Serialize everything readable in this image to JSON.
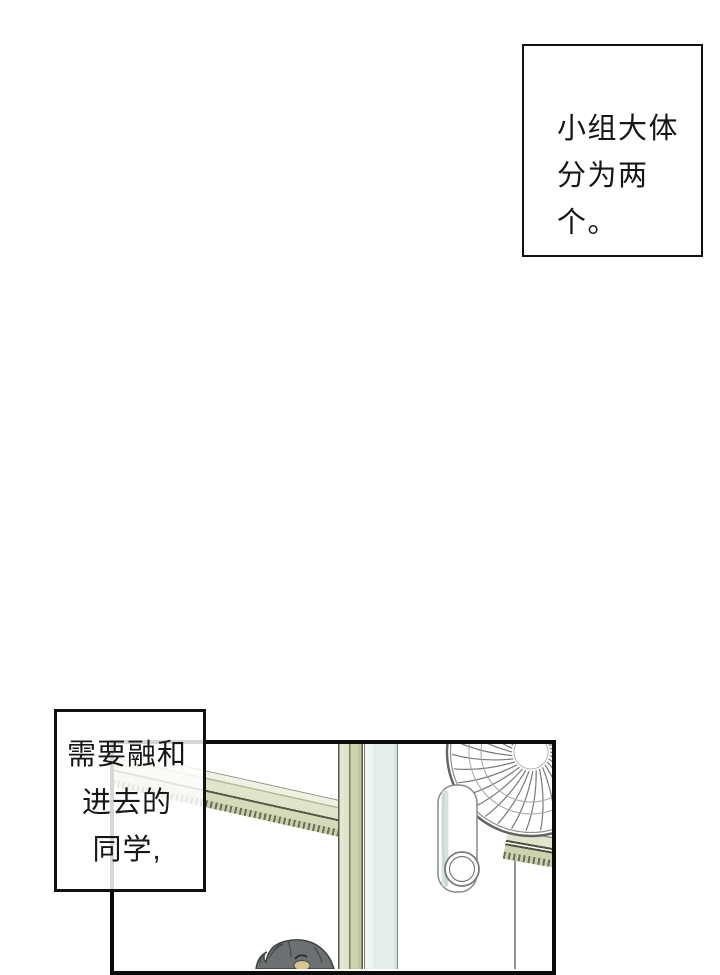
{
  "page": {
    "background": "#ffffff"
  },
  "captions": {
    "top_right": {
      "lines": [
        "小组大体",
        "分为两个。"
      ]
    },
    "left": {
      "lines": [
        "需要融和",
        "进去的",
        "同学,"
      ]
    }
  },
  "panel": {
    "scene_elements": [
      "window-frame",
      "window-glass",
      "electric-fan",
      "hanging-handle",
      "student-head"
    ],
    "colors": {
      "panel_border": "#0b0b0b",
      "frame_green_light": "#e0e4cb",
      "frame_green_mid": "#ccd3ae",
      "frame_pale": "#eff1e2",
      "frame_outline": "#575c49",
      "glass_blue": "#e3edeb",
      "fan_stroke": "#767b7a",
      "fan_rim": "#5f6463",
      "hair": "#6c7071",
      "hair_stroke": "#3d4142",
      "skin": "#d9c48f"
    }
  }
}
